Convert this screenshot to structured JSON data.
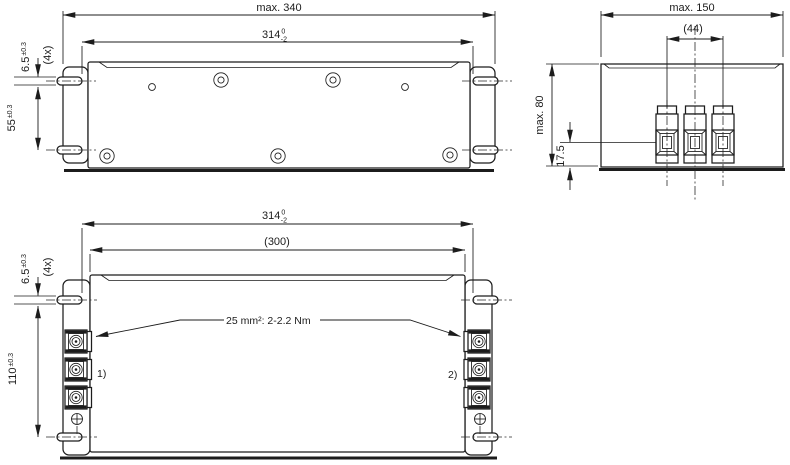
{
  "title": "EMC filter dimensional drawing",
  "colors": {
    "background": "#ffffff",
    "line": "#1c1c1c"
  },
  "top_view": {
    "dim_overall_length": "max. 340",
    "dim_slot_span_length": {
      "value": "314",
      "tol_upper": "0",
      "tol_lower": "-2"
    },
    "dim_slot_width": {
      "value": "6.5",
      "tol": "±0.3",
      "count": "(4x)"
    },
    "dim_slot_span_depth": {
      "value": "55",
      "tol": "±0.3"
    }
  },
  "side_view": {
    "dim_overall_depth": "max. 150",
    "dim_terminal_pitch": "(44)",
    "dim_overall_height": "max. 80",
    "dim_terminal_center_height": "17.5"
  },
  "bottom_view": {
    "dim_slot_span_length": {
      "value": "314",
      "tol_upper": "0",
      "tol_lower": "-2"
    },
    "dim_body_length": "(300)",
    "dim_slot_width": {
      "value": "6.5",
      "tol": "±0.3",
      "count": "(4x)"
    },
    "dim_slot_span_width": {
      "value": "110",
      "tol": "±0.3"
    },
    "terminal_note": "25 mm²: 2-2.2 Nm",
    "callout_1": "1)",
    "callout_2": "2)"
  }
}
